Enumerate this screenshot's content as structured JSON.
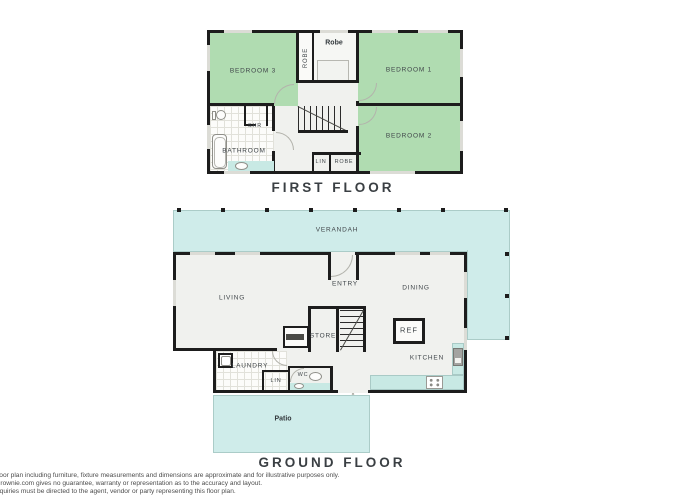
{
  "first_floor": {
    "title": "FIRST FLOOR",
    "labels": {
      "bedroom3": "BEDROOM 3",
      "bedroom1": "BEDROOM 1",
      "bedroom2": "BEDROOM 2",
      "bathroom": "BATHROOM",
      "shower": "SHR",
      "robe_left": "ROBE",
      "robe_top": "Robe",
      "linen": "LIN",
      "robe_bottom": "ROBE"
    }
  },
  "ground_floor": {
    "title": "GROUND FLOOR",
    "labels": {
      "verandah": "VERANDAH",
      "living": "LIVING",
      "entry": "ENTRY",
      "dining": "DINING",
      "store": "STORE",
      "kitchen": "KITCHEN",
      "refrigerator": "REF",
      "laundry": "LAUNDRY",
      "linen": "LIN",
      "wc": "WC",
      "patio": "Patio"
    }
  },
  "disclaimer": {
    "line1": "floor plan including furniture, fixture measurements and dimensions are approximate and for illustrative purposes only.",
    "line2": "Brownie.com gives no guarantee, warranty or representation as to the accuracy and layout.",
    "line3": "nquiries must be directed to the agent, vendor or party representing this floor plan."
  },
  "colors": {
    "bedroom_green": "#b0dcb1",
    "outdoor_teal": "#cfecea",
    "counter_teal": "#c8e9e4",
    "wall_black": "#1d1d1d",
    "floor_grey": "#f0f1ee"
  }
}
